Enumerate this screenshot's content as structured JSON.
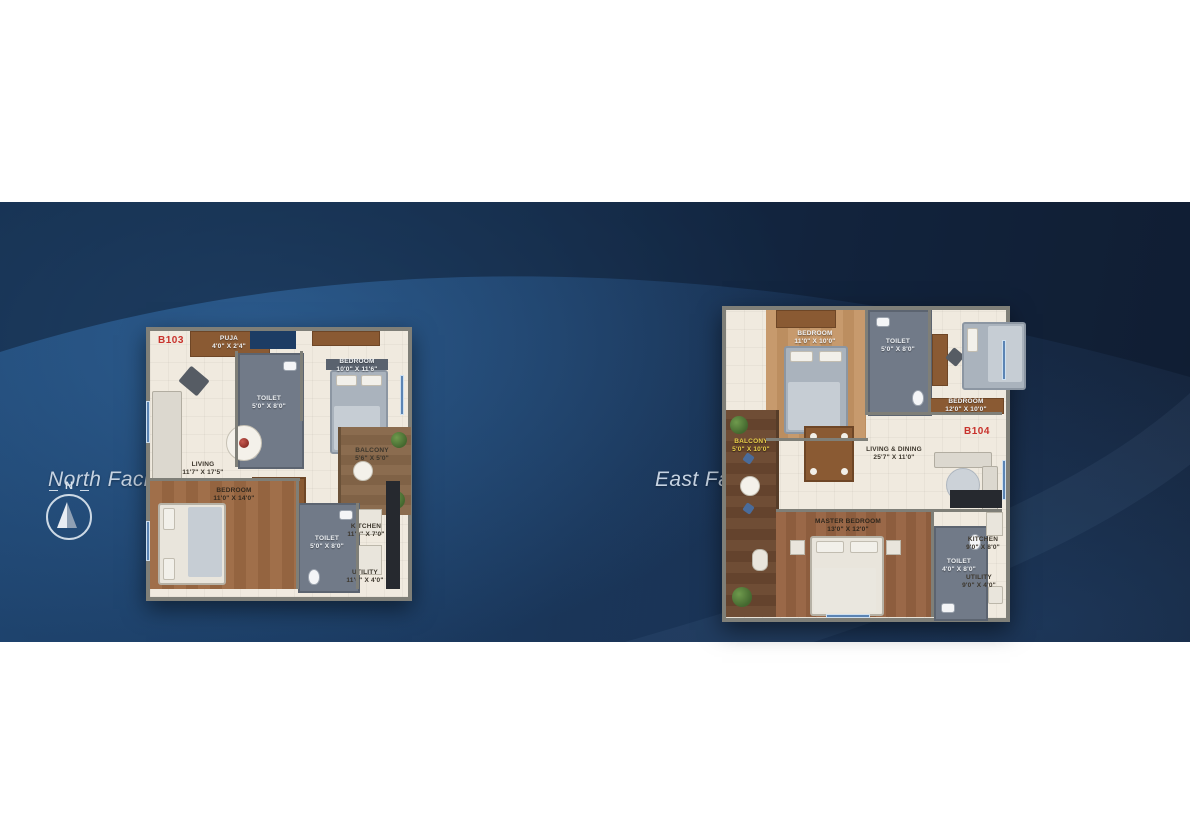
{
  "compass": {
    "north_label": "N"
  },
  "colors": {
    "banner_navy": "#172c4a",
    "banner_light_blue": "#3872ac",
    "unit_red": "#c8312b",
    "title_blue_white": "#c6d3e2",
    "balcony_label_yellow": "#e9cf49"
  },
  "plans": [
    {
      "unit": "B103",
      "title": "North Facing 2 BHK (1255 Sq ft.)",
      "rooms": [
        {
          "name": "PUJA",
          "dims": "4'0\" X 2'4\""
        },
        {
          "name": "TOILET",
          "dims": "5'0\" X 8'0\""
        },
        {
          "name": "BEDROOM",
          "dims": "10'0\" X 11'6\""
        },
        {
          "name": "LIVING",
          "dims": "11'7\" X 17'5\""
        },
        {
          "name": "BALCONY",
          "dims": "5'6\" X 5'0\""
        },
        {
          "name": "BEDROOM",
          "dims": "11'0\" X 14'0\""
        },
        {
          "name": "TOILET",
          "dims": "5'0\" X 8'0\""
        },
        {
          "name": "KITCHEN",
          "dims": "11'0\" X 7'0\""
        },
        {
          "name": "UTILITY",
          "dims": "11'0\" X 4'0\""
        }
      ]
    },
    {
      "unit": "B104",
      "title": "East Facing 3 BHK (1530 Sq ft.)",
      "rooms": [
        {
          "name": "BEDROOM",
          "dims": "11'0\" X 10'0\""
        },
        {
          "name": "TOILET",
          "dims": "5'0\" X 8'0\""
        },
        {
          "name": "BEDROOM",
          "dims": "12'0\" X 10'0\""
        },
        {
          "name": "LIVING & DINING",
          "dims": "25'7\" X 11'0\""
        },
        {
          "name": "BALCONY",
          "dims": "5'0\" X 10'0\""
        },
        {
          "name": "MASTER BEDROOM",
          "dims": "13'0\" X 12'0\""
        },
        {
          "name": "TOILET",
          "dims": "4'0\" X 8'0\""
        },
        {
          "name": "KITCHEN",
          "dims": "9'0\" X 8'0\""
        },
        {
          "name": "UTILITY",
          "dims": "9'0\" X 4'0\""
        }
      ]
    }
  ]
}
